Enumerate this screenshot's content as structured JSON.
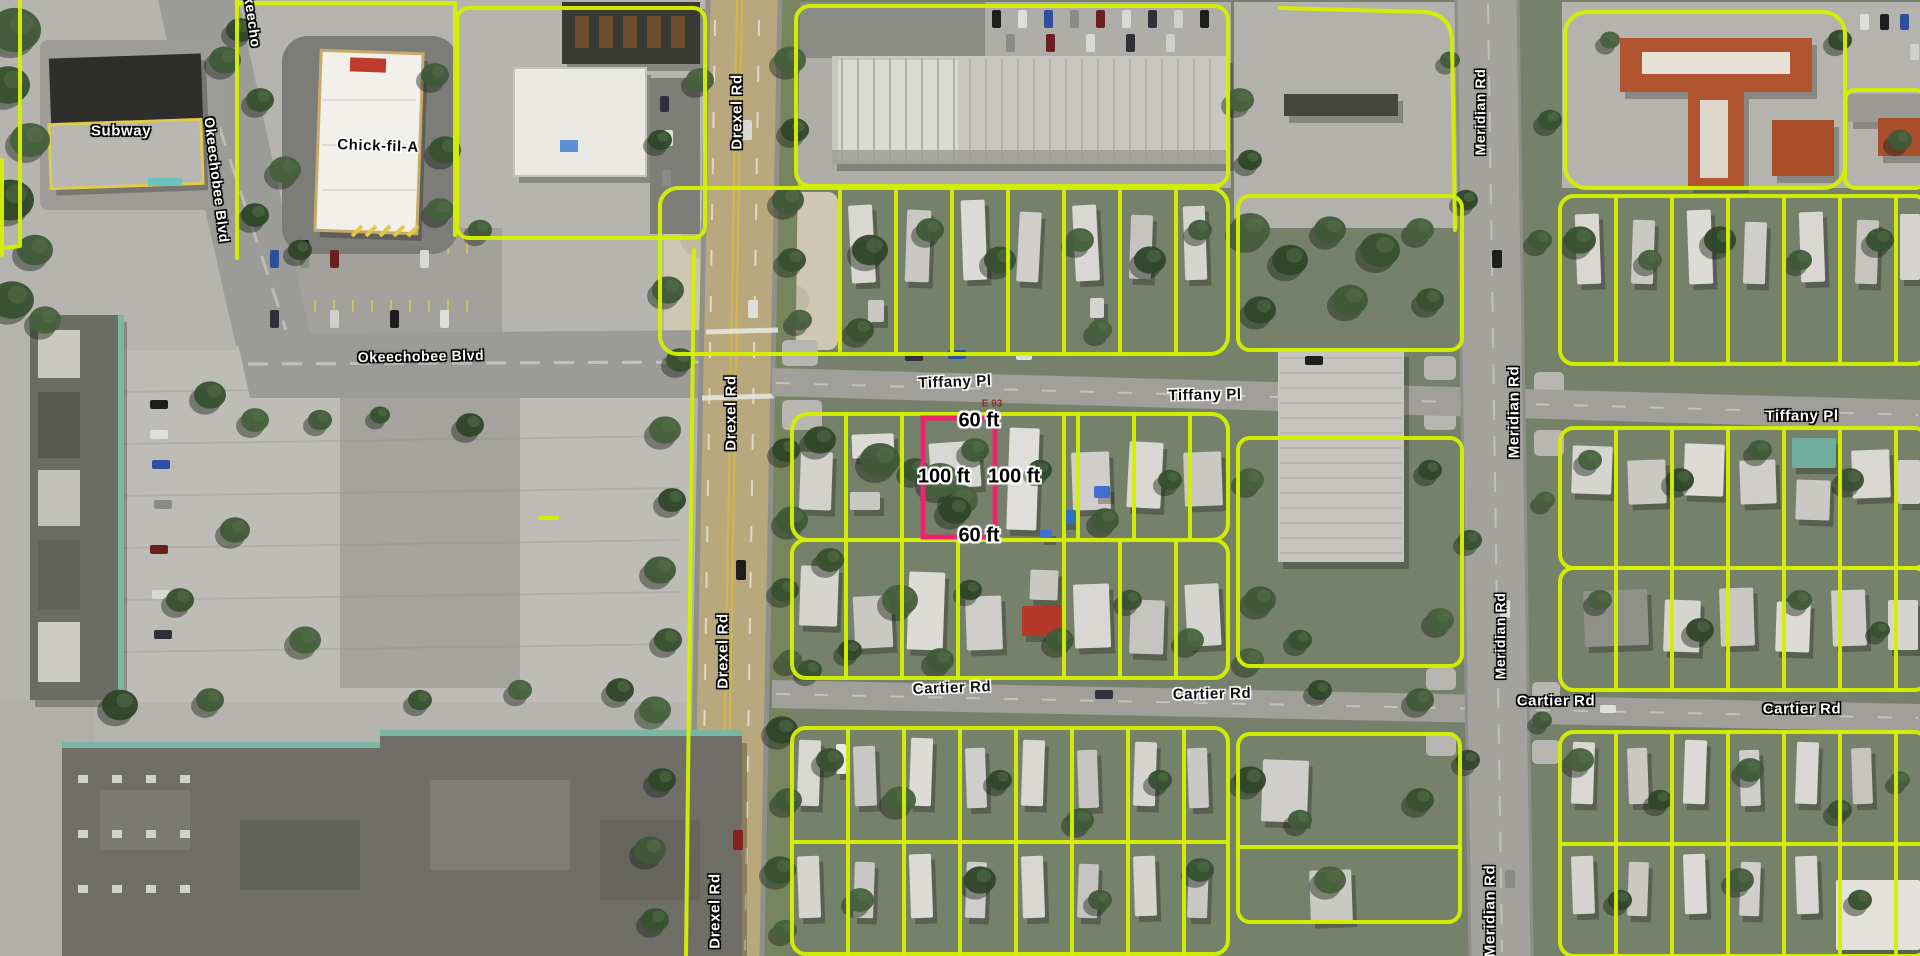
{
  "title": "Aerial parcel map with highlighted lot",
  "colors": {
    "parcel_outline": "#D4F000",
    "highlight_outline": "#E9256D",
    "label_white": "#FFFFFF",
    "label_dark": "#111111",
    "drexel_road_surface": "#B9A87D",
    "cross_road_surface": "#A09F9A"
  },
  "highlight_parcel": {
    "frontage_label": "60 ft",
    "depth_label": "100 ft",
    "outline_color": "#E9256D"
  },
  "labels": [
    {
      "name": "street-label-okeechobee-top",
      "text": "Okeecho",
      "x": 252,
      "y": 16,
      "rot": 82,
      "style": "white",
      "size": 14
    },
    {
      "name": "street-label-okeechobee-nw",
      "text": "Okeechobee Blvd",
      "x": 217,
      "y": 180,
      "rot": 83,
      "style": "white",
      "size": 14
    },
    {
      "name": "business-label-subway",
      "text": "Subway",
      "x": 121,
      "y": 131,
      "rot": 0,
      "style": "white",
      "size": 15
    },
    {
      "name": "business-label-chick-fil-a",
      "text": "Chick-fil-A",
      "x": 378,
      "y": 146,
      "rot": 2,
      "style": "black",
      "size": 15
    },
    {
      "name": "street-label-okeechobee-blvd",
      "text": "Okeechobee Blvd",
      "x": 421,
      "y": 356,
      "rot": -1,
      "style": "white",
      "size": 14
    },
    {
      "name": "street-label-drexel-rd-1",
      "text": "Drexel Rd",
      "x": 737,
      "y": 112,
      "rot": -90,
      "style": "white",
      "size": 15
    },
    {
      "name": "street-label-drexel-rd-2",
      "text": "Drexel Rd",
      "x": 731,
      "y": 413,
      "rot": -90,
      "style": "white",
      "size": 15
    },
    {
      "name": "street-label-drexel-rd-3",
      "text": "Drexel Rd",
      "x": 723,
      "y": 651,
      "rot": -90,
      "style": "white",
      "size": 15
    },
    {
      "name": "street-label-drexel-rd-4",
      "text": "Drexel Rd",
      "x": 715,
      "y": 911,
      "rot": -90,
      "style": "white",
      "size": 15
    },
    {
      "name": "street-label-tiffany-pl-1",
      "text": "Tiffany Pl",
      "x": 955,
      "y": 382,
      "rot": -2,
      "style": "black",
      "size": 15
    },
    {
      "name": "street-label-tiffany-pl-2",
      "text": "Tiffany Pl",
      "x": 1205,
      "y": 395,
      "rot": -1,
      "style": "black",
      "size": 15
    },
    {
      "name": "street-label-tiffany-pl-3",
      "text": "Tiffany Pl",
      "x": 1802,
      "y": 416,
      "rot": 0,
      "style": "white",
      "size": 15
    },
    {
      "name": "street-label-cartier-rd-1",
      "text": "Cartier Rd",
      "x": 952,
      "y": 688,
      "rot": -2,
      "style": "black",
      "size": 15
    },
    {
      "name": "street-label-cartier-rd-2",
      "text": "Cartier Rd",
      "x": 1212,
      "y": 694,
      "rot": -1,
      "style": "black",
      "size": 15
    },
    {
      "name": "street-label-cartier-rd-3",
      "text": "Cartier Rd",
      "x": 1556,
      "y": 701,
      "rot": 0,
      "style": "white",
      "size": 15
    },
    {
      "name": "street-label-cartier-rd-4",
      "text": "Cartier Rd",
      "x": 1802,
      "y": 709,
      "rot": 0,
      "style": "white",
      "size": 15
    },
    {
      "name": "street-label-meridian-rd-1",
      "text": "Meridian Rd",
      "x": 1480,
      "y": 112,
      "rot": -90,
      "style": "white",
      "size": 14
    },
    {
      "name": "street-label-meridian-rd-2",
      "text": "Meridian Rd",
      "x": 1514,
      "y": 412,
      "rot": -90,
      "style": "white",
      "size": 15
    },
    {
      "name": "street-label-meridian-rd-3",
      "text": "Meridian Rd",
      "x": 1500,
      "y": 636,
      "rot": -90,
      "style": "white",
      "size": 14
    },
    {
      "name": "street-label-meridian-rd-4",
      "text": "Meridian Rd",
      "x": 1490,
      "y": 911,
      "rot": -90,
      "style": "white",
      "size": 15
    },
    {
      "name": "dimension-label-width-top",
      "text": "60 ft",
      "x": 979,
      "y": 421,
      "rot": 0,
      "style": "dim",
      "size": 20
    },
    {
      "name": "dimension-label-depth-left",
      "text": "100 ft",
      "x": 944,
      "y": 477,
      "rot": 0,
      "style": "dim",
      "size": 20
    },
    {
      "name": "dimension-label-depth-right",
      "text": "100 ft",
      "x": 1014,
      "y": 477,
      "rot": 0,
      "style": "dim",
      "size": 20
    },
    {
      "name": "dimension-label-width-bottom",
      "text": "60 ft",
      "x": 979,
      "y": 536,
      "rot": 0,
      "style": "dim",
      "size": 20
    },
    {
      "name": "annotation-label",
      "text": "E 93",
      "x": 992,
      "y": 404,
      "rot": 0,
      "style": "red",
      "size": 10
    }
  ]
}
